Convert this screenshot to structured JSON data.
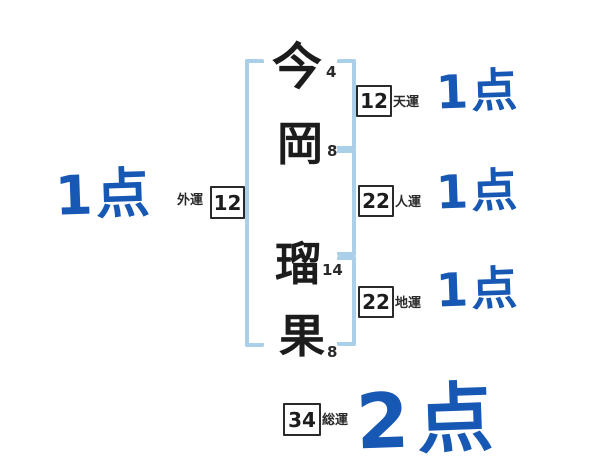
{
  "diagram": {
    "characters": [
      {
        "char": "今",
        "strokes": "4"
      },
      {
        "char": "岡",
        "strokes": "8"
      },
      {
        "char": "瑠",
        "strokes": "14"
      },
      {
        "char": "果",
        "strokes": "8"
      }
    ],
    "fortunes": {
      "heaven": {
        "label": "天運",
        "value": "12",
        "score": "1点"
      },
      "person": {
        "label": "人運",
        "value": "22",
        "score": "1点"
      },
      "earth": {
        "label": "地運",
        "value": "22",
        "score": "1点"
      },
      "outer": {
        "label": "外運",
        "value": "12",
        "score": "1点"
      },
      "total": {
        "label": "総運",
        "value": "34",
        "score": "2点"
      }
    },
    "colors": {
      "score_blue": "#1658b3",
      "bracket_blue": "#a9cfe9",
      "ink": "#1f1f1f"
    }
  }
}
